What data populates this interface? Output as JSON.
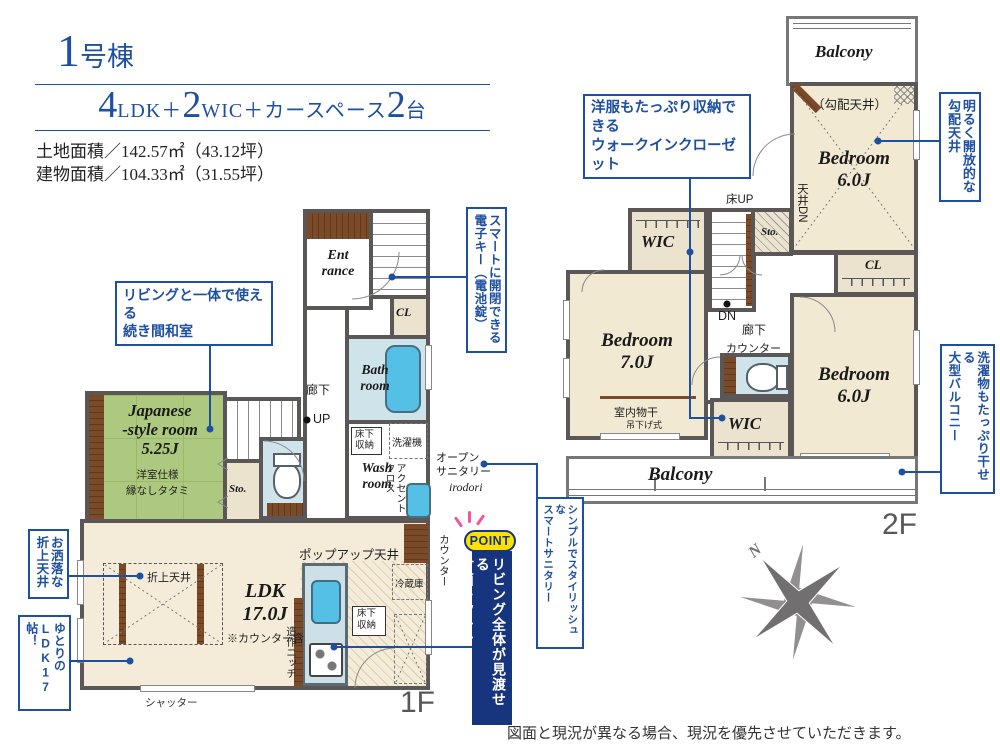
{
  "title": {
    "number": "1",
    "suffix": "号棟"
  },
  "spec": {
    "n1": "4",
    "u1": "LDK＋",
    "n2": "2",
    "u2": "WIC＋カースペース",
    "n3": "2",
    "u3": "台"
  },
  "areas": {
    "land": "土地面積／142.57㎡（43.12坪）",
    "building": "建物面積／104.33㎡（31.55坪）"
  },
  "floor1": {
    "floor_label": "1F",
    "entrance": "Ent\nrance",
    "cl": "CL",
    "bath": "Bath\nroom",
    "wash": "Wash\nroom",
    "hallway": "廊下",
    "up": "UP",
    "underfloor": "床下\n収納",
    "washer": "洗濯機",
    "accent_cloth": "アクセント\nクロス",
    "open_sanitary": "オープン\nサニタリー",
    "irodori": "irodori",
    "japanese_room": "Japanese\n-style room\n5.25J",
    "japanese_note": "洋室仕様\n縁なしタタミ",
    "storage": "Sto.",
    "ps": "PS",
    "counter_toilet": "カウンター",
    "counter_kitchen": "カウンター",
    "popup_ceiling": "ポップアップ天井",
    "fridge": "冷蔵庫",
    "underfloor2": "床下\n収納",
    "niche": "造作ニッチ",
    "ldk": "LDK\n17.0J",
    "ldk_note": "※カウンター含",
    "folded_ceiling": "折上天井",
    "shutter": "シャッター"
  },
  "floor2": {
    "floor_label": "2F",
    "balcony_top": "Balcony",
    "sloped_ceiling": "（勾配天井）",
    "bedroom1": "Bedroom\n6.0J",
    "wic_top": "WIC",
    "bedroom2": "Bedroom\n7.0J",
    "floor_up": "床UP",
    "ceiling_dn": "天井DN",
    "storage": "Sto.",
    "dn": "DN",
    "hallway": "廊下",
    "counter": "カウンター",
    "cl": "CL",
    "bedroom3": "Bedroom\n6.0J",
    "indoor_drying": "室内物干",
    "hanging": "吊下げ式",
    "wic_bottom": "WIC",
    "balcony_bottom": "Balcony"
  },
  "callouts": {
    "washitsu": "リビングと一体で使える\n続き間和室",
    "oshare": "お洒落な\n折上天井",
    "yutori": "ゆとりの\nLDK17帖！",
    "smart_key": "スマートに開閉できる\n電子キー（電池錠）",
    "wic": "洋服もたっぷり収納できる\nウォークインクローゼット",
    "sloped": "明るく開放的な\n勾配天井",
    "balcony": "洗濯物もたっぷり干せる\n大型バルコニー",
    "sanitary": "シンプルでスタイリッシュな\nスマートサニタリー"
  },
  "point": {
    "badge": "POINT",
    "text": "リビング全体が見渡せる\n対面キッチン"
  },
  "compass": {
    "north": "N"
  },
  "disclaimer": "図面と現況が異なる場合、現況を優先させていただきます。",
  "colors": {
    "accent_blue": "#1e50a2",
    "navy": "#16357e",
    "wall": "#5a5756",
    "tatami_green": "#adc97f",
    "room_beige": "#f2e9d2",
    "bath_blue": "#cfe4ea",
    "wood_brown": "#7b4a28",
    "point_yellow": "#ffe100",
    "ray_pink": "#f0569b"
  }
}
